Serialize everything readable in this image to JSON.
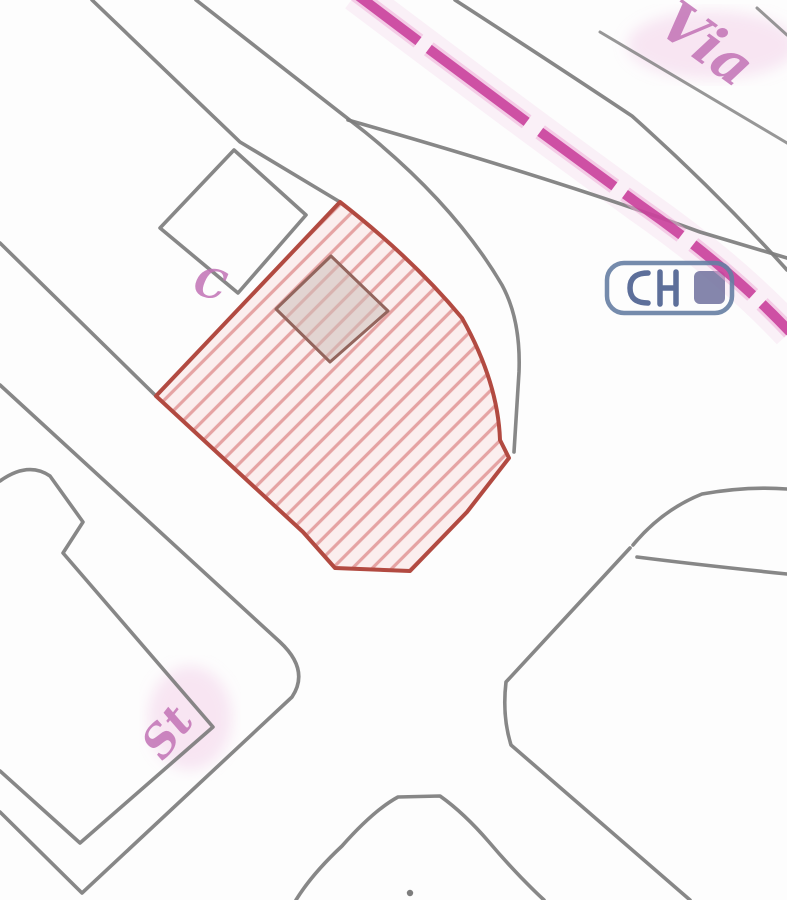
{
  "map": {
    "type": "cadastral-map-extract",
    "description": "Cadastral map crop: gray parcel and road boundary lines, one red-hatched highlighted parcel with a small building footprint, a dashed pink road marking crossing the top-right, pink italic street labels, and a blue boxed map symbol.",
    "colors": {
      "background": "#fdfdfd",
      "parcel_line_gray": "#7d7d7d",
      "highlight_boundary_red": "#b24a41",
      "hatch_red": "#e5a3a3",
      "hatch_wash": "#fbeeee",
      "road_marking_pink": "#c73a98",
      "road_marking_halo": "#eeb4da",
      "label_pink": "#c273b6",
      "symbol_blue": "#667ea3",
      "symbol_blue_fill": "#70719d",
      "building_fill": "#cdbfb9",
      "building_stroke": "#93655d"
    },
    "labels": {
      "street_top_right": {
        "text": "Via",
        "transform": "translate(655,30) rotate(36)"
      },
      "street_bottom_left": {
        "text": "St",
        "transform": "translate(163,762) rotate(-52)"
      },
      "parcel_letter": {
        "text": "C",
        "transform": "translate(192,294) rotate(12)"
      }
    },
    "paths": {
      "road_upper_left_a": "M92,0 L240,142 L340,202",
      "road_upper_left_b": "M196,0 L365,132 Q455,205 502,285 Q521,320 519,372 L514,452",
      "pink_road_lower_edge": "M348,120 Q565,182 700,232 Q760,250 787,258",
      "pink_road_upper_edge": "M455,0 Q560,68 632,116 Q715,190 787,270",
      "topright_parcel_line_a": "M600,32 L787,143",
      "topright_parcel_line_b": "M757,8 L787,35",
      "square_parcel": "M234,150 L306,215 L238,293 L160,228 Z",
      "west_diagonal": "M0,243 L156,396",
      "west_parcel_notched": "M0,481 Q28,461 50,476 L83,522 L63,553 L213,727 L80,843 L0,771",
      "wedge_block_tip": "M0,385 L280,642 Q310,670 292,697 L82,893 L0,812",
      "bottom_arch": "M296,900 Q312,874 342,846 Q374,810 398,797 L440,796 Q464,813 489,842 Q517,875 544,900",
      "southeast_road_left": "M630,548 L506,682 Q502,716 511,745 L690,900",
      "east_junction_upper": "M633,545 Q662,510 702,494 Q747,486 787,489",
      "east_junction_lower": "M637,557 Q700,565 787,574",
      "highlight_parcel": "M340,202 Q412,258 462,318 Q498,382 500,440 L509,458 L467,512 L410,571 L335,568 L303,532 L156,396 Z",
      "building_footprint": "M331,256 L388,311 L330,362 L276,309 Z",
      "pink_road_centerline": "M356,-6 Q520,118 640,205 Q730,268 790,332"
    },
    "symbols": {
      "blue_box": {
        "name": "blue-boxed-cadastral-symbol",
        "x": 607,
        "y": 263,
        "width": 125,
        "height": 50
      },
      "point_marker": {
        "x": 410,
        "y": 893
      }
    }
  }
}
